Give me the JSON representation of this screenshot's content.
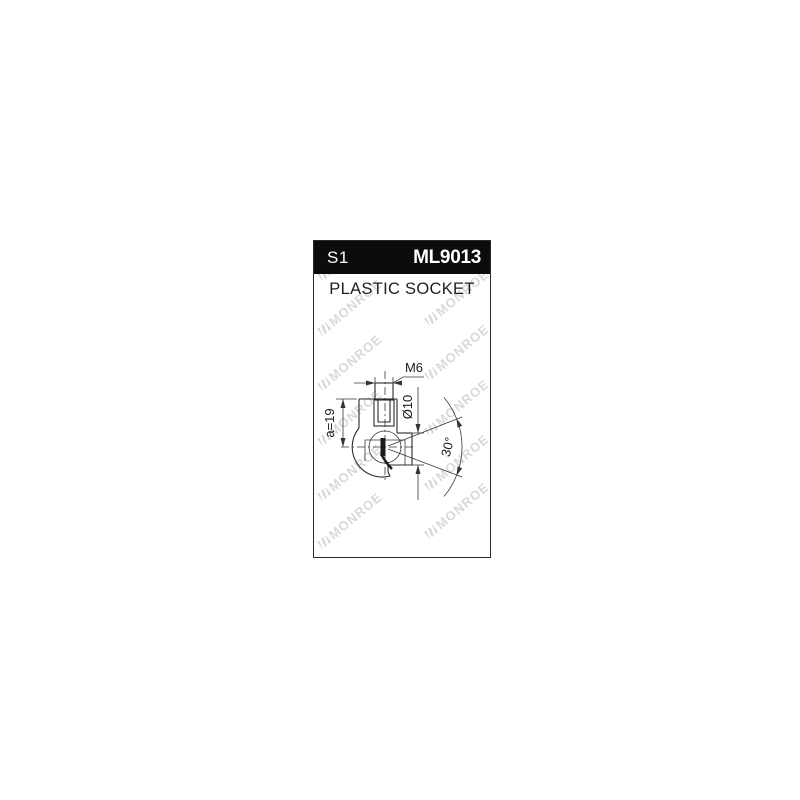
{
  "product_card": {
    "header": {
      "type_code": "S1",
      "part_number": "ML9013"
    },
    "title": "PLASTIC SOCKET",
    "watermark_text": "MONROE",
    "drawing": {
      "labels": {
        "thread": "M6",
        "diameter": "Ø10",
        "length": "a=19",
        "angle": "30°"
      }
    },
    "colors": {
      "header_bg": "#0c0c0c",
      "header_text": "#ffffff",
      "line": "#2b2b2b",
      "watermark": "#d9d9d9",
      "border": "#2a2a2a"
    }
  }
}
